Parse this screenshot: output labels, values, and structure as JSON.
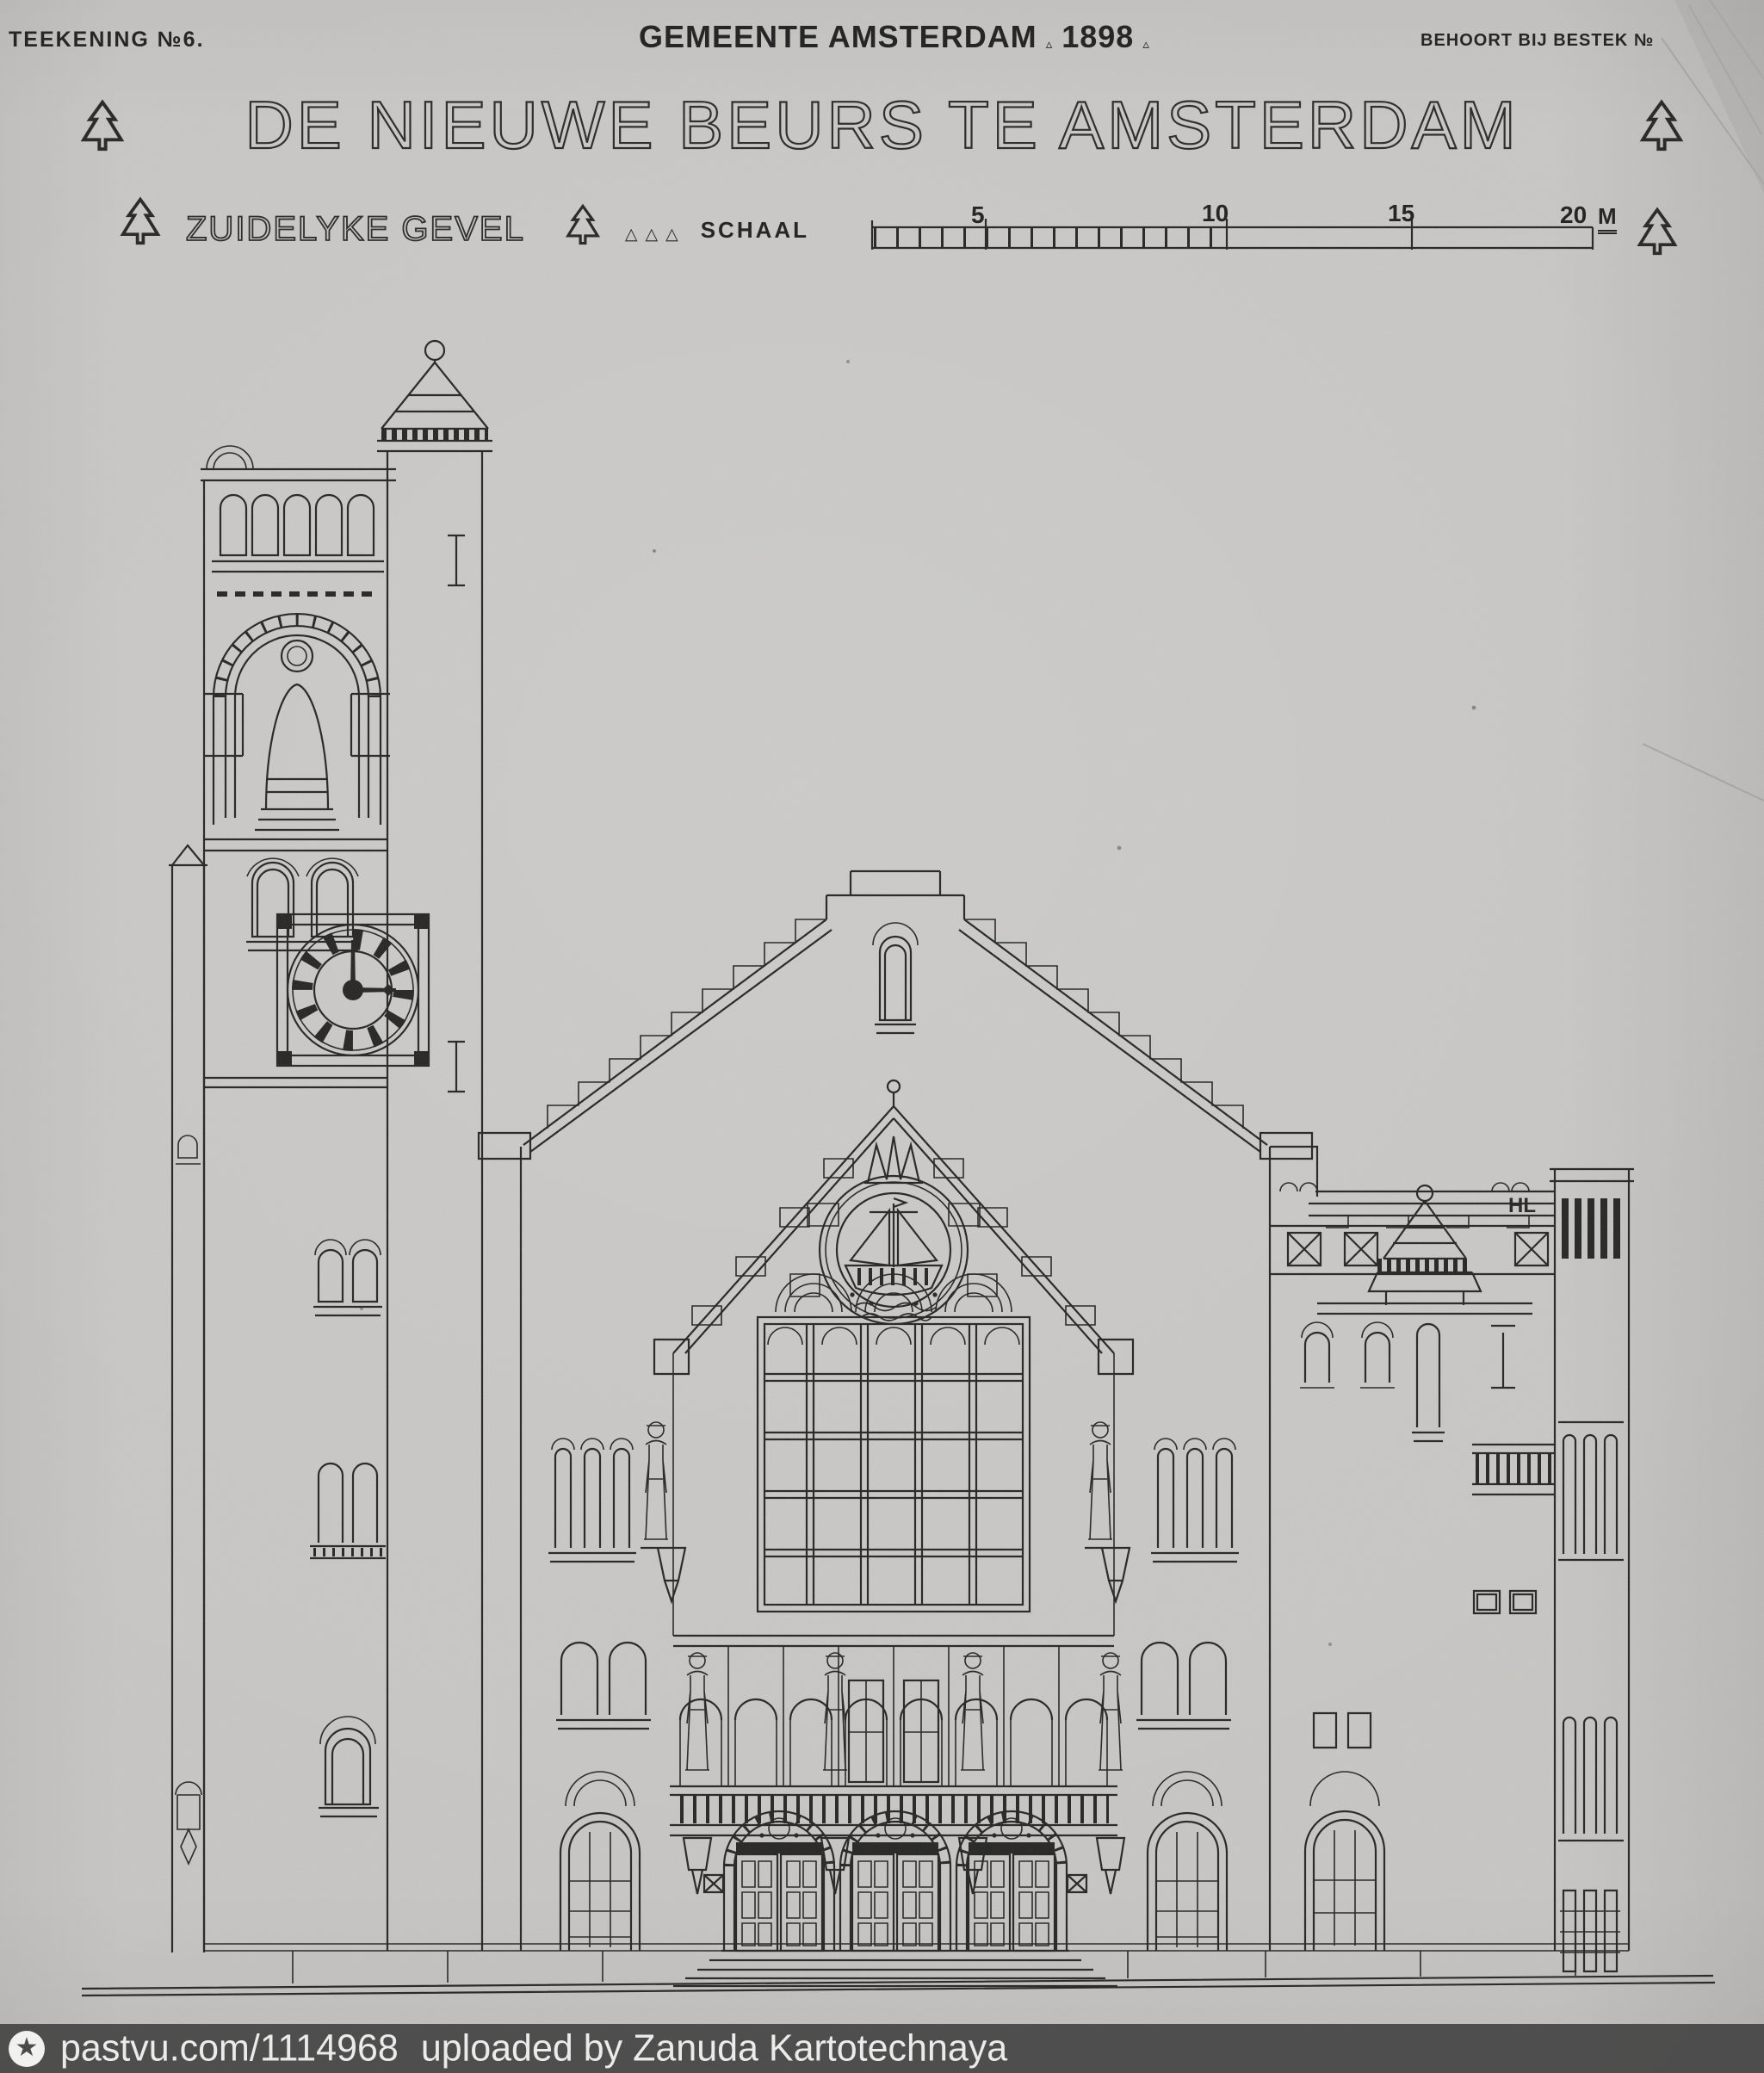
{
  "page": {
    "header": {
      "left": "TEEKENING №6.",
      "center": "GEMEENTE AMSTERDAM",
      "year": "1898",
      "right": "BEHOORT BIJ BESTEK №"
    },
    "title": "DE NIEUWE BEURS TE AMSTERDAM",
    "subtitle": "ZUIDELYKE GEVEL",
    "scale": {
      "label": "SCHAAL",
      "ticks": [
        "5",
        "10",
        "15",
        "20"
      ],
      "unit": "M"
    },
    "drawing": {
      "subject": "south-elevation-of-new-exchange-building",
      "annotation": "HL",
      "clock_time": "3:00"
    },
    "watermark": {
      "site": "pastvu.com/1114968",
      "credit": "uploaded by Zanuda Kartotechnaya"
    }
  },
  "icons": {
    "tree_mark": "fir-tree outline mark",
    "separator": "▵",
    "watermark_logo": "★"
  },
  "colors": {
    "paper": "#c7c6c3",
    "ink": "#222220",
    "watermark_bar": "#484848",
    "watermark_text": "#ebebe9"
  }
}
